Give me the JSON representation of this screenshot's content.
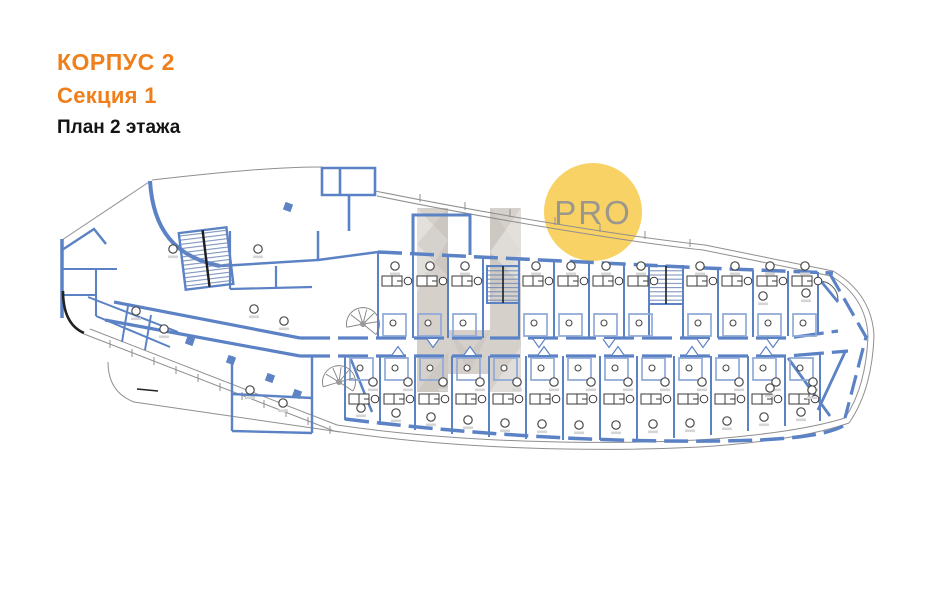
{
  "header": {
    "line1": "КОРПУС 2",
    "line2": "Секция 1",
    "line3": "План 2 этажа"
  },
  "badge": {
    "label": "PRO"
  },
  "colors": {
    "accent_orange": "#EF7F1A",
    "title_black": "#141414",
    "wall_blue": "#5C82C6",
    "wall_blue_light": "#8FA9D8",
    "outline_gray": "#8F8F8F",
    "detail_dark": "#222222",
    "badge_yellow": "#F7CF59",
    "badge_text": "#9B968E",
    "watermark_beige": "#B3AAA0"
  }
}
